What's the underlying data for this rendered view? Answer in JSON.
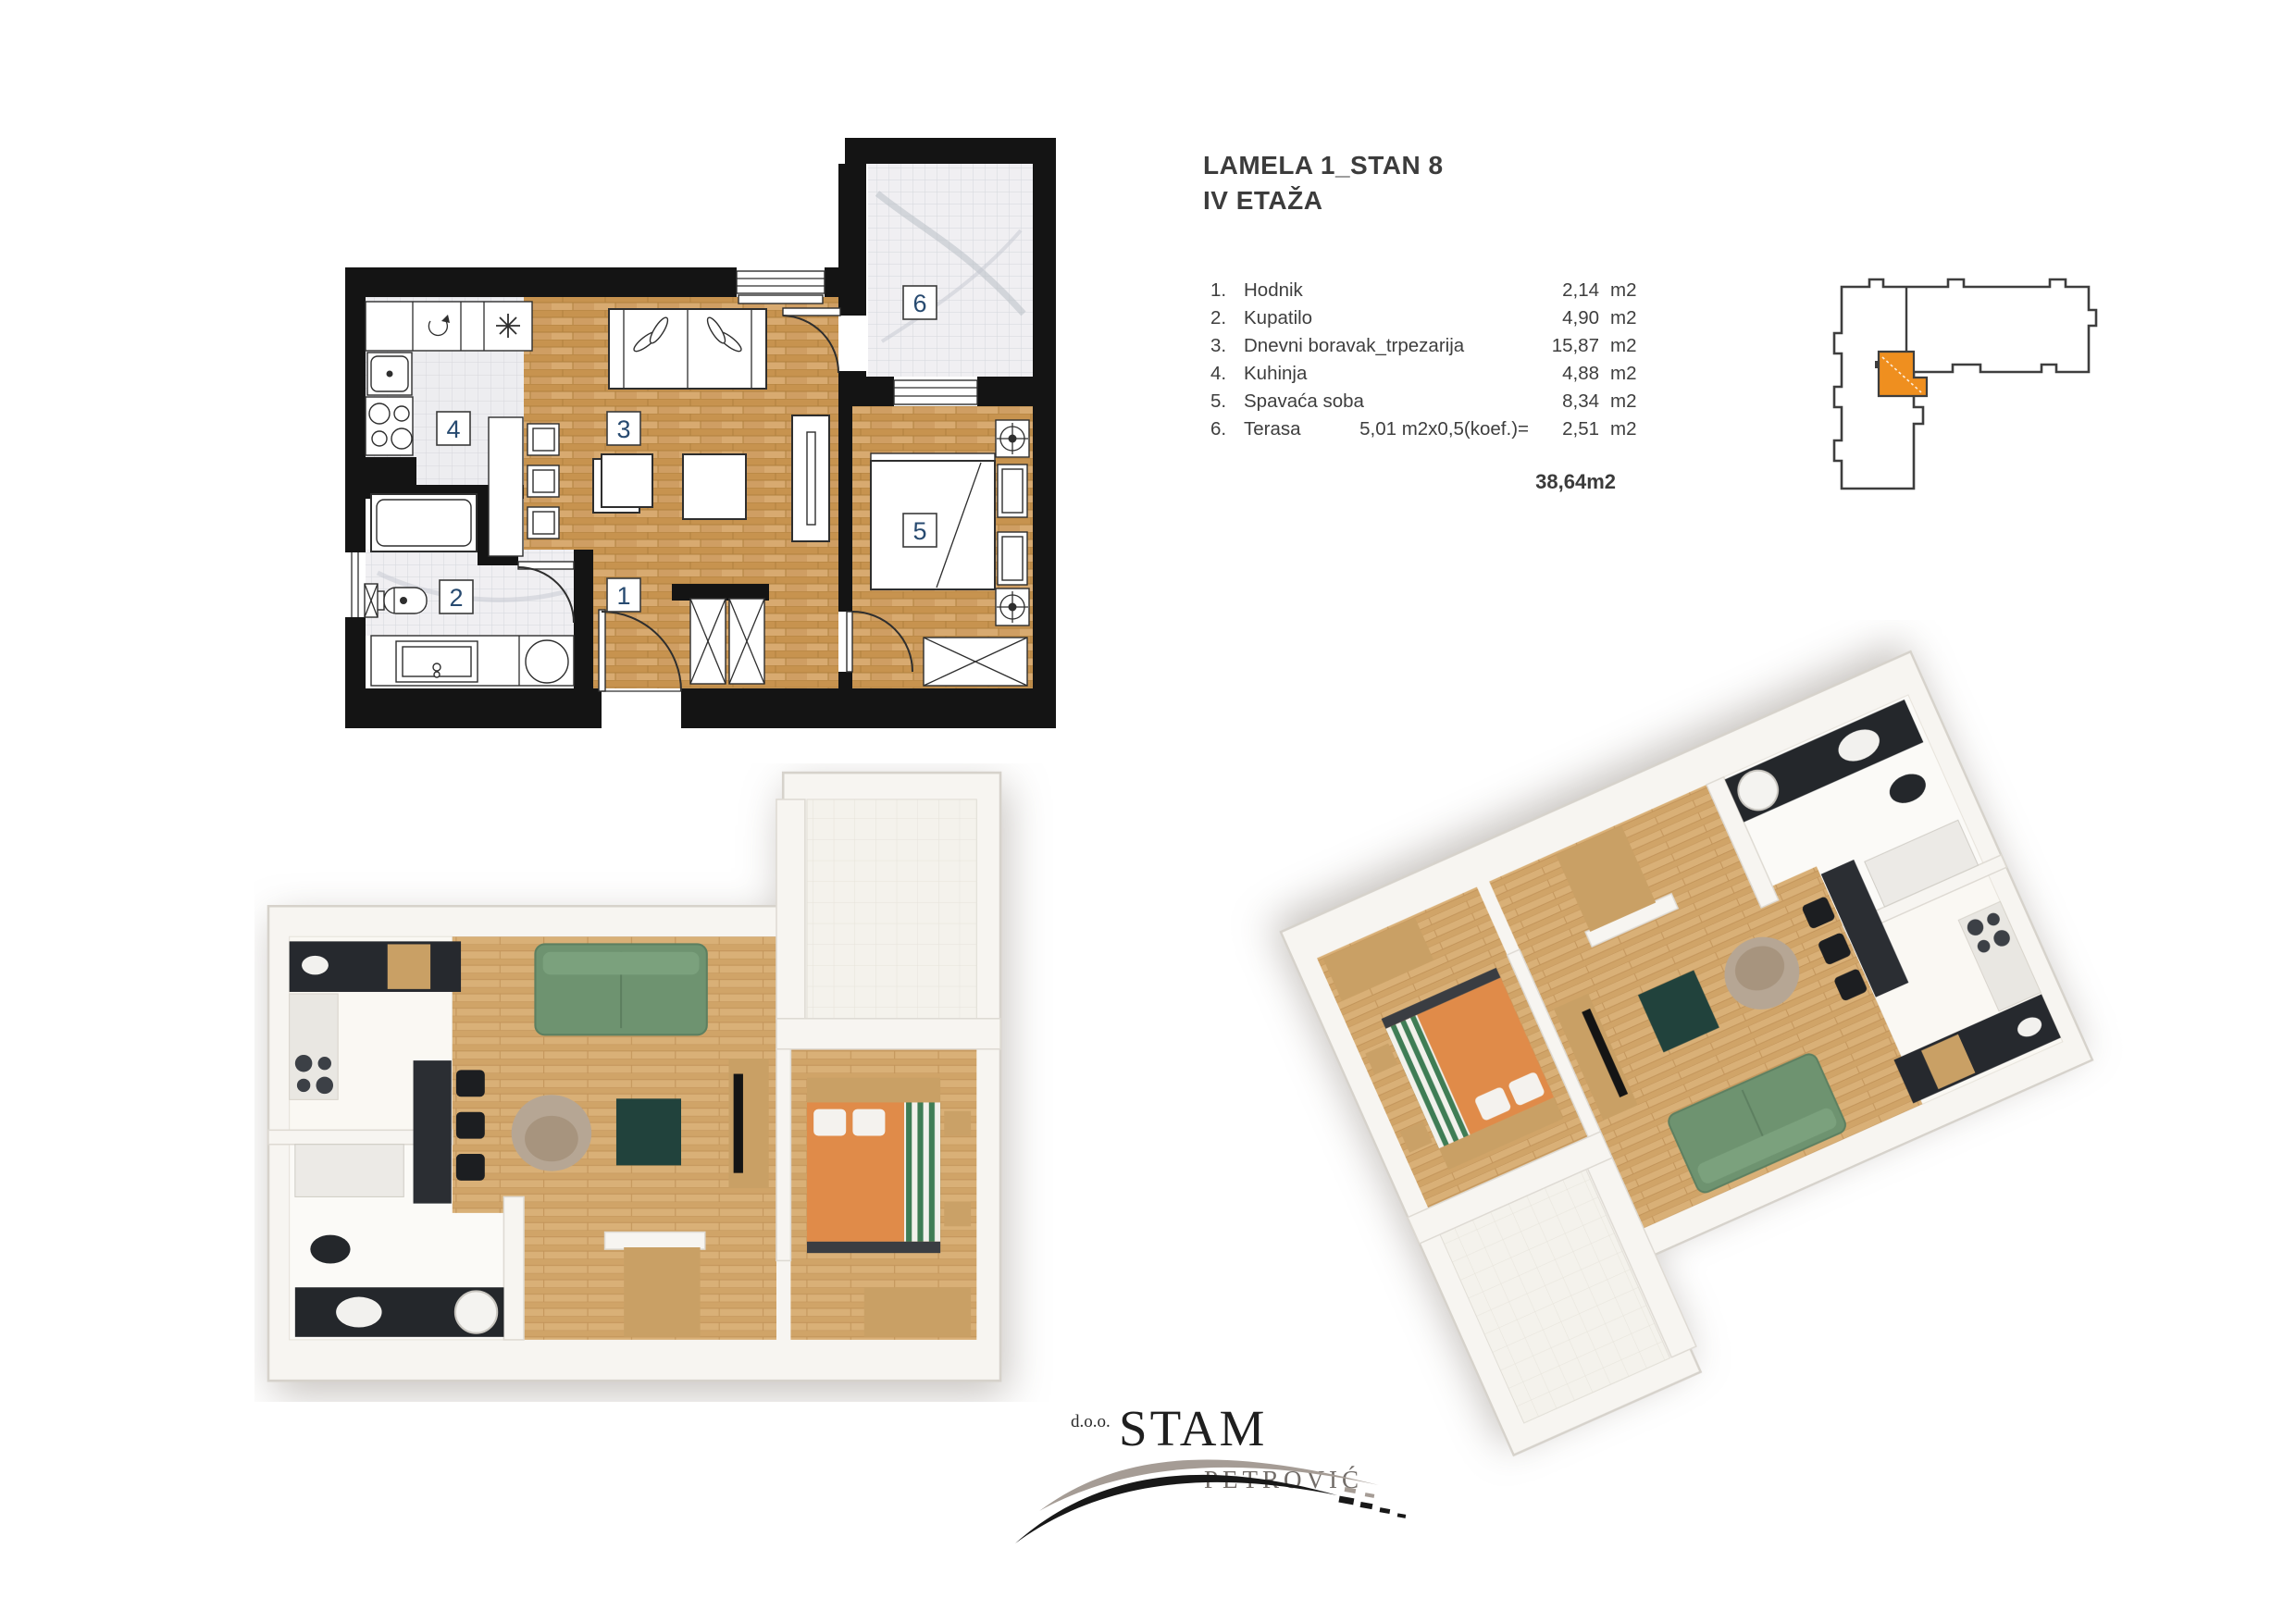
{
  "header": {
    "title_line1": "LAMELA 1_STAN 8",
    "title_line2": "IV ETAŽA"
  },
  "room_table": {
    "rows": [
      {
        "num": "1.",
        "name": "Hodnik",
        "note": "",
        "value": "2,14",
        "unit": "m2"
      },
      {
        "num": "2.",
        "name": "Kupatilo",
        "note": "",
        "value": "4,90",
        "unit": "m2"
      },
      {
        "num": "3.",
        "name": "Dnevni boravak_trpezarija",
        "note": "",
        "value": "15,87",
        "unit": "m2"
      },
      {
        "num": "4.",
        "name": "Kuhinja",
        "note": "",
        "value": "4,88",
        "unit": "m2"
      },
      {
        "num": "5.",
        "name": "Spavaća soba",
        "note": "",
        "value": "8,34",
        "unit": "m2"
      },
      {
        "num": "6.",
        "name": "Terasa",
        "note": "5,01 m2x0,5(koef.)=",
        "value": "2,51",
        "unit": "m2"
      }
    ],
    "total": "38,64m2"
  },
  "plan2d": {
    "labels": {
      "hallway": "1",
      "bathroom": "2",
      "living": "3",
      "kitchen": "4",
      "bedroom": "5",
      "terrace": "6"
    }
  },
  "logo": {
    "prefix": "d.o.o.",
    "name": "STAM",
    "subname": "PETROVIĆ"
  },
  "colors": {
    "highlight_orange": "#ef8f1f",
    "wall_black": "#141414",
    "wood": "#cf9e63",
    "sofa_green": "#6e9370",
    "bed_orange": "#e08b49",
    "counter_dark": "#26292e",
    "label_blue": "#274a70",
    "text_dark": "#3f3f3f"
  }
}
